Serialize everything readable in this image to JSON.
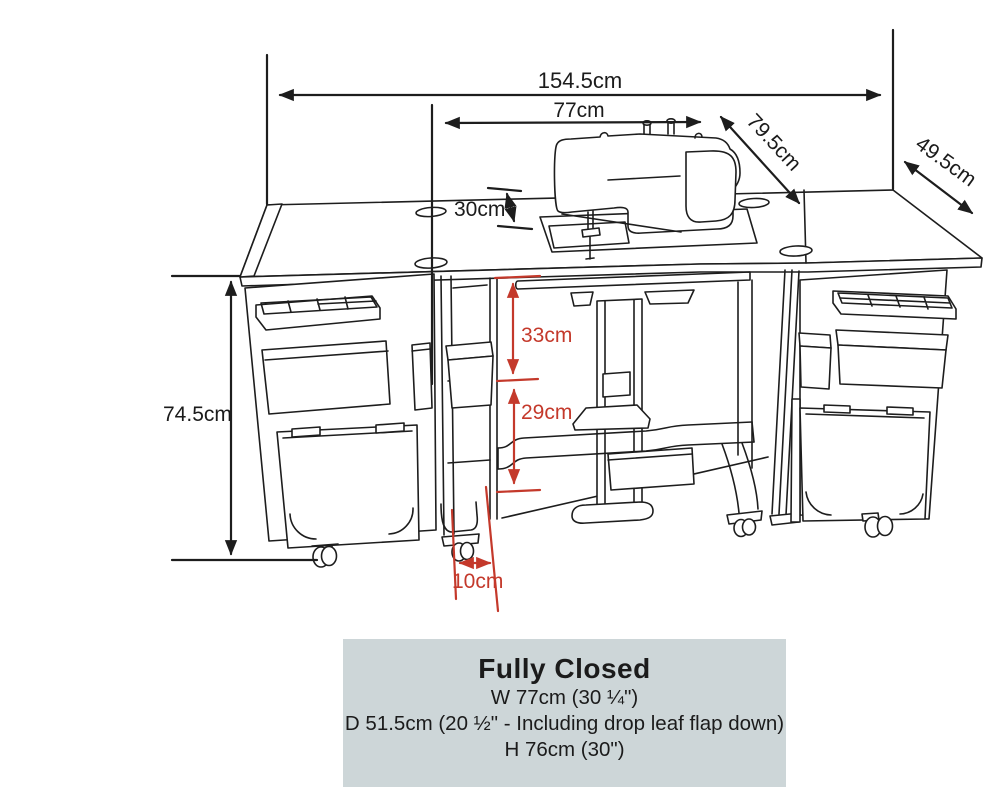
{
  "diagram": {
    "dimension_labels": {
      "total_width": "154.5cm",
      "opening_width": "77cm",
      "depth_total": "79.5cm",
      "leaf_depth": "49.5cm",
      "machine_height": "30cm",
      "cabinet_height": "74.5cm",
      "upper_clearance": "33cm",
      "lower_clearance": "29cm",
      "caster_inset": "10cm"
    },
    "colors": {
      "line": "#1d1d1d",
      "red": "#c4392b",
      "box_bg": "#cdd6d8",
      "text": "#1b1b1b",
      "background": "#ffffff"
    }
  },
  "info_box": {
    "title": "Fully Closed",
    "lines": [
      "W 77cm (30 ¼\")",
      "D 51.5cm (20 ½\" - Including drop leaf flap down)",
      "H 76cm (30\")"
    ]
  }
}
